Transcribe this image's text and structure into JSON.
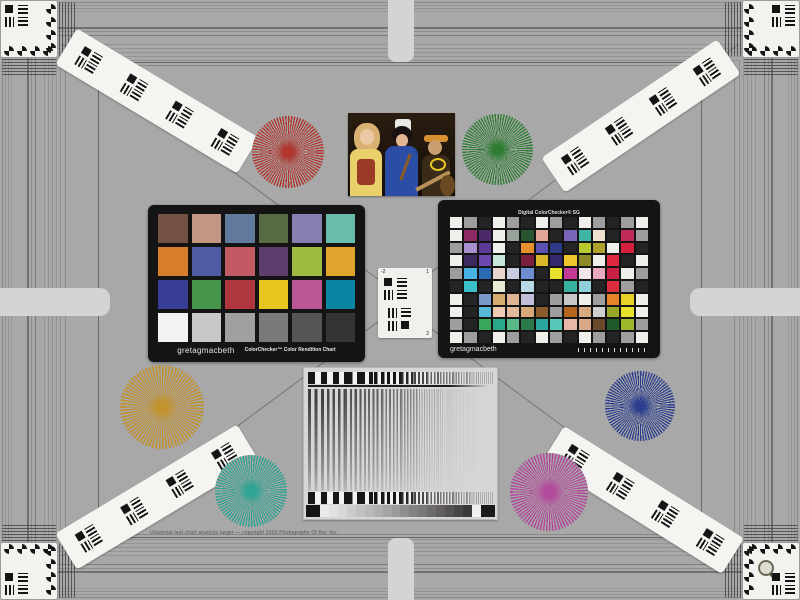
{
  "canvas": {
    "background": "#a8a8a8",
    "card_black": "#141414",
    "strip_white": "#f4f4f1"
  },
  "colorchecker_classic": {
    "brand": "gretagmacbeth",
    "title": "ColorChecker™ Color Rendition Chart",
    "rows": 4,
    "cols": 6,
    "patches": [
      "#735244",
      "#c29682",
      "#627a9d",
      "#576c43",
      "#8580b1",
      "#67bdaa",
      "#d67e2c",
      "#505ba6",
      "#c15a63",
      "#5e3c6c",
      "#9dbc40",
      "#e0a32e",
      "#383d96",
      "#469449",
      "#af363c",
      "#e7c71f",
      "#bb5695",
      "#0885a1",
      "#f3f3f2",
      "#c8c8c8",
      "#a0a0a0",
      "#7a7a79",
      "#555555",
      "#343434"
    ]
  },
  "colorchecker_sg": {
    "title": "Digital ColorChecker® SG",
    "brand": "gretagmacbeth",
    "rows": 10,
    "cols": 14,
    "patches": [
      "#f0efec",
      "#9e9e9e",
      "#242424",
      "#f0efec",
      "#9e9e9e",
      "#242424",
      "#f0efec",
      "#9e9e9e",
      "#242424",
      "#f0efec",
      "#9e9e9e",
      "#242424",
      "#9e9e9e",
      "#f0efec",
      "#f0efec",
      "#8e2b66",
      "#4b2a6b",
      "#f0efec",
      "#97a39b",
      "#27552f",
      "#e0a597",
      "#242424",
      "#7a66b8",
      "#3fb5a5",
      "#efe0cf",
      "#242424",
      "#c12a56",
      "#9e9e9e",
      "#9e9e9e",
      "#a88fce",
      "#5e3a96",
      "#f0efec",
      "#242424",
      "#e5902c",
      "#5a51b2",
      "#2d3a86",
      "#242424",
      "#b7c92e",
      "#b0a12c",
      "#f0efec",
      "#d4213d",
      "#242424",
      "#f0efec",
      "#3c2a5e",
      "#6c49ae",
      "#c7e6da",
      "#242424",
      "#7a1f3d",
      "#d8b72a",
      "#332a6e",
      "#efc52c",
      "#8d8a27",
      "#f0efec",
      "#e0263f",
      "#242424",
      "#f0efec",
      "#9e9e9e",
      "#46b3e2",
      "#2a6bb3",
      "#e8d6ce",
      "#c8cce0",
      "#6e8ed2",
      "#242424",
      "#e8e22c",
      "#c23a96",
      "#f0e6ea",
      "#e8a9c0",
      "#c81f44",
      "#f0efec",
      "#9e9e9e",
      "#242424",
      "#39c0c8",
      "#242424",
      "#e6ecd4",
      "#242424",
      "#b7d9e6",
      "#242424",
      "#242424",
      "#38b2a0",
      "#8fd0dc",
      "#242424",
      "#db2d3e",
      "#9e9e9e",
      "#242424",
      "#f0efec",
      "#242424",
      "#7b99c8",
      "#d7aa6e",
      "#e0b493",
      "#c2bfd8",
      "#242424",
      "#9e9e9e",
      "#c8c8c8",
      "#f0efec",
      "#9e9e9e",
      "#e5822a",
      "#ecd02a",
      "#f0efec",
      "#f0efec",
      "#242424",
      "#58b8d8",
      "#eecab2",
      "#e2b99a",
      "#d9a878",
      "#8a5a2a",
      "#9e9e9e",
      "#b5651e",
      "#d9aa80",
      "#cfcfcf",
      "#9aa82a",
      "#e8e22c",
      "#f0efec",
      "#9e9e9e",
      "#242424",
      "#3aa85a",
      "#2aa88a",
      "#58b888",
      "#2a7a4a",
      "#2aa8a0",
      "#58c8b8",
      "#e8b8a8",
      "#d9aa88",
      "#6a4a2a",
      "#1f5a2a",
      "#9ab82a",
      "#9e9e9e",
      "#f0efec",
      "#9e9e9e",
      "#242424",
      "#f0efec",
      "#9e9e9e",
      "#242424",
      "#f0efec",
      "#9e9e9e",
      "#242424",
      "#f0efec",
      "#9e9e9e",
      "#242424",
      "#9e9e9e",
      "#f0efec"
    ]
  },
  "stars": [
    {
      "name": "red",
      "color": "#b0362e"
    },
    {
      "name": "green",
      "color": "#2f7d33"
    },
    {
      "name": "orange",
      "color": "#c2922f"
    },
    {
      "name": "blue",
      "color": "#2c3f8e"
    },
    {
      "name": "teal",
      "color": "#2fa493"
    },
    {
      "name": "magenta",
      "color": "#b34a9b"
    }
  ],
  "usaf": {
    "labels": [
      "-2",
      "1",
      "2"
    ]
  },
  "sweep_card": {
    "wedge_steps": [
      "#151515",
      "#ebebe9",
      "#e2e2e0",
      "#d8d8d6",
      "#cecccb",
      "#c4c2c1",
      "#bab8b7",
      "#b0aead",
      "#a6a4a3",
      "#9b9999",
      "#908e8d",
      "#858382",
      "#7a7878",
      "#6e6c6b",
      "#625f5e",
      "#555352",
      "#484645",
      "#3a3838",
      "#f0f0ee",
      "#1a1a1a"
    ]
  },
  "footer": {
    "fine_print": "Universal test chart analysis target — copyright 2000 Photography Of the, Inc."
  }
}
